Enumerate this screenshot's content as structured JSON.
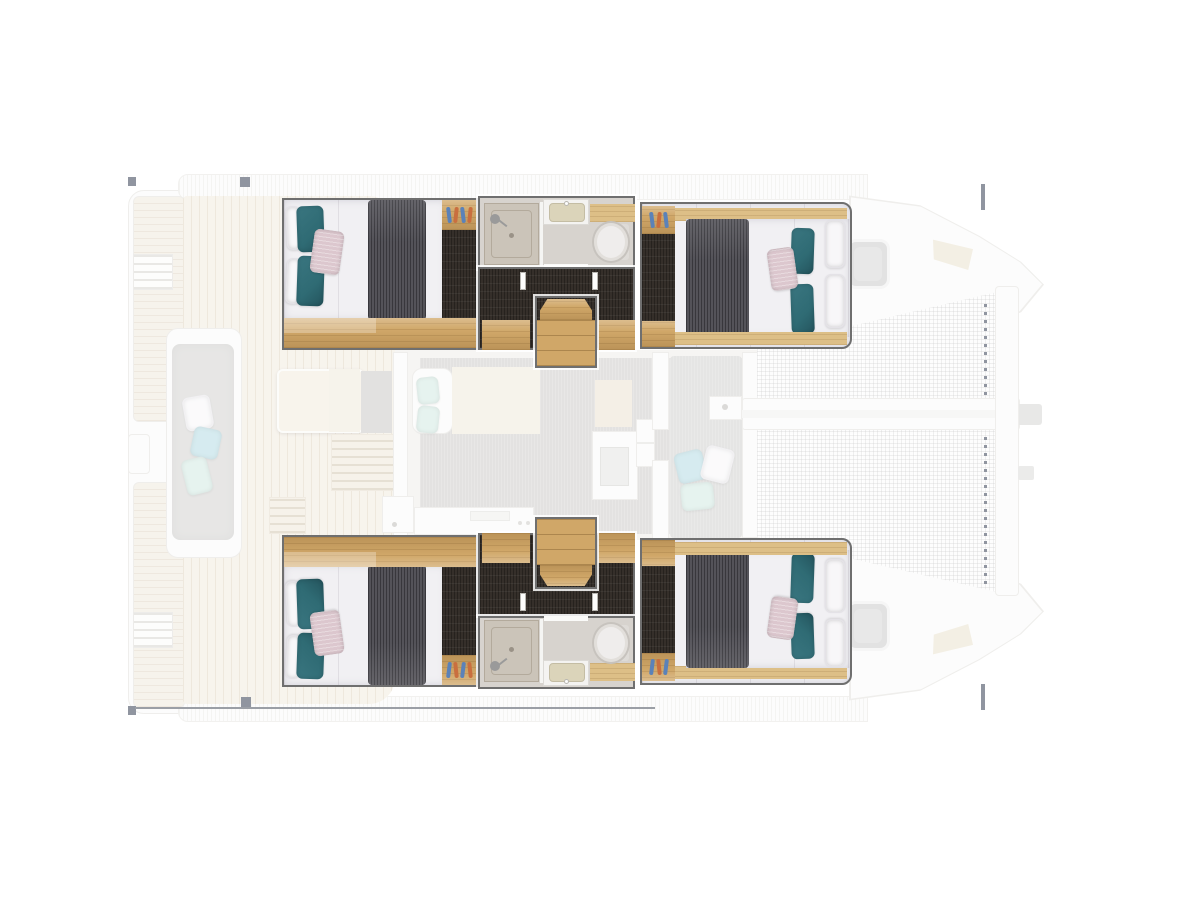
{
  "image": {
    "kind": "yacht-floorplan",
    "subject": "Catamaran deck plan, top-down view, bow to the right; four double cabins and two bathrooms in the hulls shown highlighted, deck / salon / trampoline areas ghosted",
    "background": "#ffffff"
  },
  "colors": {
    "bg": "#ffffff",
    "box-border": "#6f6f6f",
    "wood": "#d0a768",
    "wood-light": "#ddbf87",
    "dark-floor": "#352f2a",
    "duvet": "#545359",
    "mattress": "#f1f0f3",
    "mattress-line": "#e0dee3",
    "teal": "#2f6b74",
    "pink": "#dcc7ce",
    "white-pillow": "#f8f7f9",
    "bath-floor": "#d7d3ce",
    "shower-tray": "#cbc4b9",
    "shower-line": "#b3aa9c",
    "basin": "#dbd4ba",
    "toilet": "#efedec",
    "toilet-line": "#c7c3be",
    "deck-plank": "#f1eadd",
    "deck-line": "#ded2bd",
    "platform-plank": "#efe8db",
    "platform-line": "#ded3c0",
    "hull": "#fbfbfa",
    "hull-line": "#e0dfda",
    "salon-floor": "#efece8",
    "rug": "#c9c7c5",
    "mat": "#ccccca",
    "bench-cushion": "#d0cfcd",
    "table": "#f2ebdb",
    "slat-bg": "#efe7d6",
    "slat-line": "#cfc3ab",
    "mint": "#cfe9e1",
    "lightblue": "#aed9e2",
    "beige": "#efe8d8",
    "graycab": "#c7c5c3",
    "mesh-bg": "#fcfcfc",
    "hatch": "#c7c7c7",
    "hatch-ring": "#eeeeee",
    "hatch-inner": "#d2d2d2",
    "anchor": "#e9e0ca",
    "navy": "#232e44",
    "bottle-blue": "#5b82b8",
    "bottle-orange": "#c96f3f",
    "darkline": "#39424f"
  },
  "regions": {
    "aft_cockpit": "Aft cockpit",
    "port_swim_platform": "Port swim platform",
    "stbd_swim_platform": "Starboard swim platform",
    "transom_bench": "Transom bench seat",
    "cockpit_table": "Cockpit table",
    "salon": "Salon",
    "galley": "Galley",
    "nav_station": "Nav station",
    "fwd_cockpit": "Forward cockpit lounge",
    "port_trampoline": "Port trampoline",
    "stbd_trampoline": "Starboard trampoline",
    "bowsprit": "Bowsprit longeron",
    "crossbeam": "Forward crossbeam",
    "port_bow_deck": "Port bow deck",
    "stbd_bow_deck": "Starboard bow deck",
    "port_deck_hatch": "Port deck hatch",
    "stbd_deck_hatch": "Starboard deck hatch",
    "port_aft_cabin": "Port aft cabin",
    "port_bathroom": "Port bathroom",
    "port_companionway": "Port companionway",
    "port_stairs": "Port hull stairs",
    "port_fwd_cabin": "Port forward cabin",
    "stbd_aft_cabin": "Starboard aft cabin",
    "stbd_bathroom": "Starboard bathroom",
    "stbd_companionway": "Starboard companionway",
    "stbd_stairs": "Starboard hull stairs",
    "stbd_fwd_cabin": "Starboard forward cabin"
  }
}
